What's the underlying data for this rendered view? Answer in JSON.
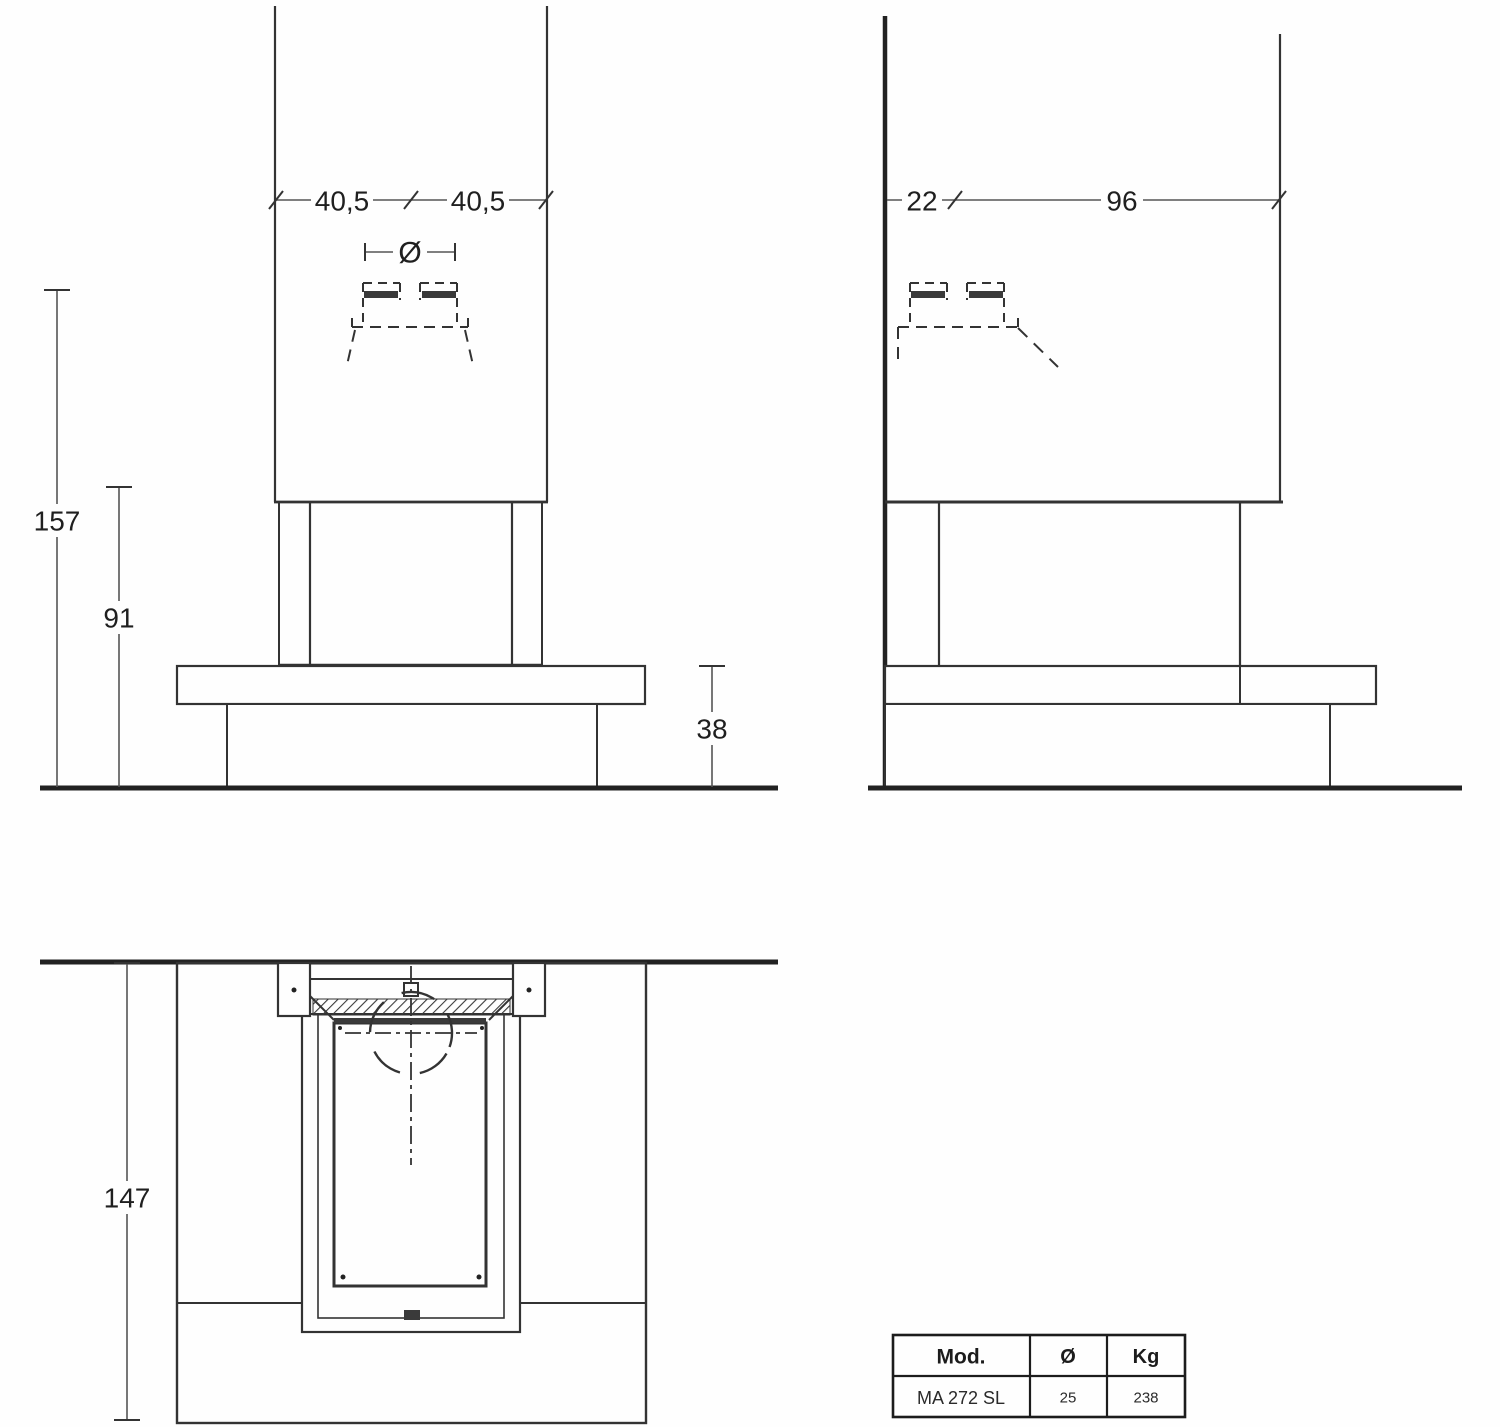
{
  "drawing": {
    "front": {
      "dim_width_left": "40,5",
      "dim_width_right": "40,5",
      "dim_flue_symbol": "Ø",
      "dim_total_height": "157",
      "dim_opening_height": "91",
      "dim_hearth_height": "38"
    },
    "side": {
      "dim_wall_offset": "22",
      "dim_depth": "96"
    },
    "plan": {
      "dim_total_depth": "147"
    },
    "colors": {
      "line": "#333333",
      "dim_line": "#555555",
      "text": "#1f1f1f"
    }
  },
  "table": {
    "headers": [
      "Mod.",
      "Ø",
      "Kg"
    ],
    "rows": [
      [
        "MA 272 SL",
        "25",
        "238"
      ]
    ]
  }
}
